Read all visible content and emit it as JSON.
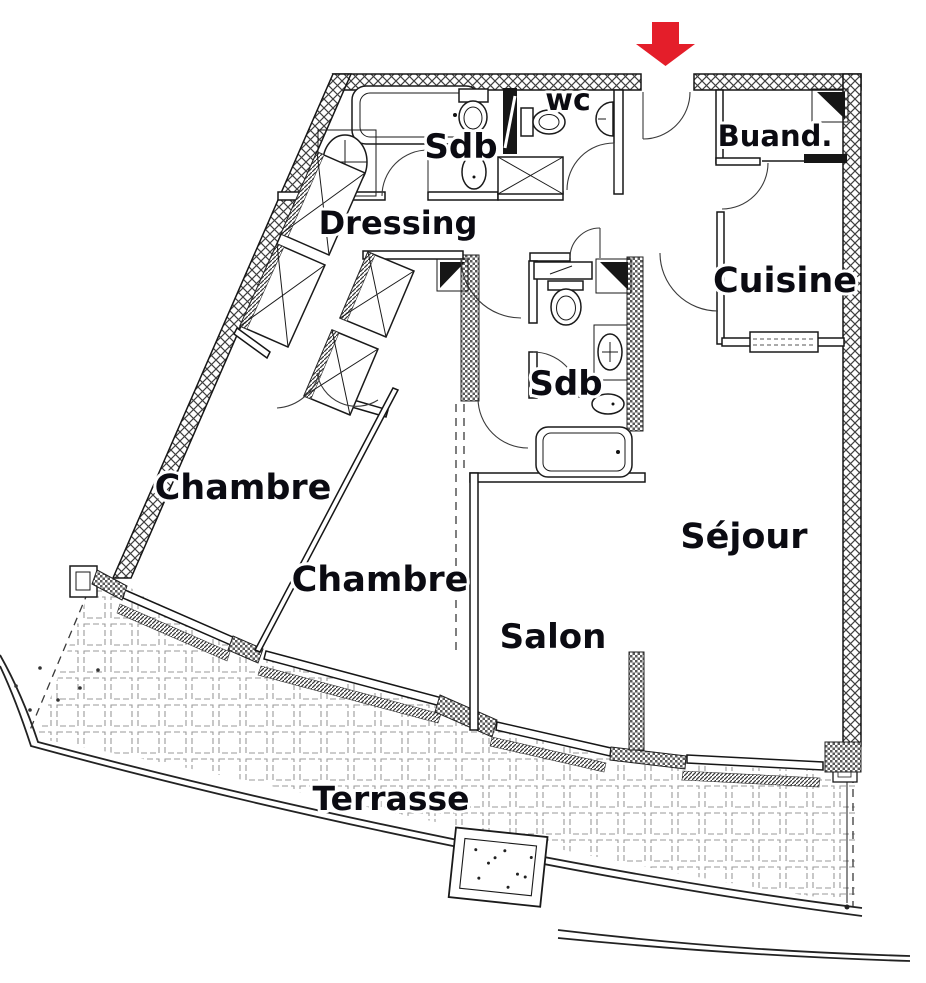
{
  "page": {
    "background": "#ffffff",
    "type": "apartment-floor-plan"
  },
  "colors": {
    "ink": "#1a1a1a",
    "entrance_arrow": "#e41e2a",
    "label_color": "#0b0b12",
    "tile_line": "#8f8f8f"
  },
  "icons": {
    "entrance_arrow": "red-down-arrow"
  },
  "rooms": {
    "bathroom_main": {
      "label": "Sdb"
    },
    "wc": {
      "label": "wc"
    },
    "laundry": {
      "label": "Buand."
    },
    "dressing": {
      "label": "Dressing"
    },
    "kitchen": {
      "label": "Cuisine"
    },
    "bathroom_2": {
      "label": "Sdb"
    },
    "bedroom_1": {
      "label": "Chambre"
    },
    "bedroom_2": {
      "label": "Chambre"
    },
    "lounge": {
      "label": "Salon"
    },
    "living_room": {
      "label": "Séjour"
    },
    "terrace": {
      "label": "Terrasse"
    }
  }
}
